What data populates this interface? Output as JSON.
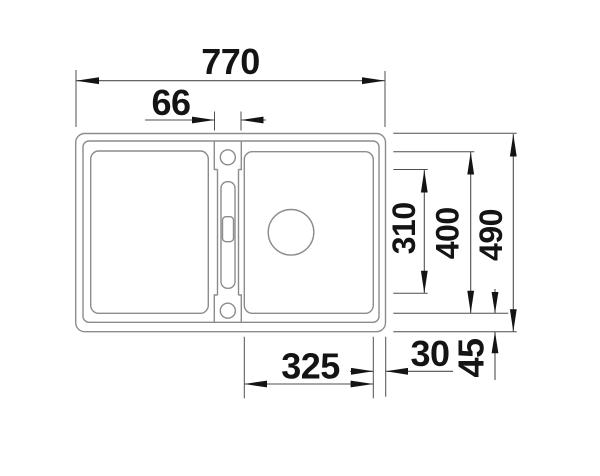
{
  "drawing": {
    "kind": "sink-installation-dimension-drawing",
    "view": "top-view",
    "labels": {
      "width_total": "770",
      "tap_ledge_width": "66",
      "ledge_length": "310",
      "bowl_length": "400",
      "depth_total": "490",
      "bowl_width": "325",
      "edge_gap": "30",
      "front_rim": "45"
    },
    "colors": {
      "background": "#ffffff",
      "sink_outline": "#8c8c8c",
      "dimension_lines": "#4f4f4f",
      "dimension_text": "#141414"
    }
  }
}
